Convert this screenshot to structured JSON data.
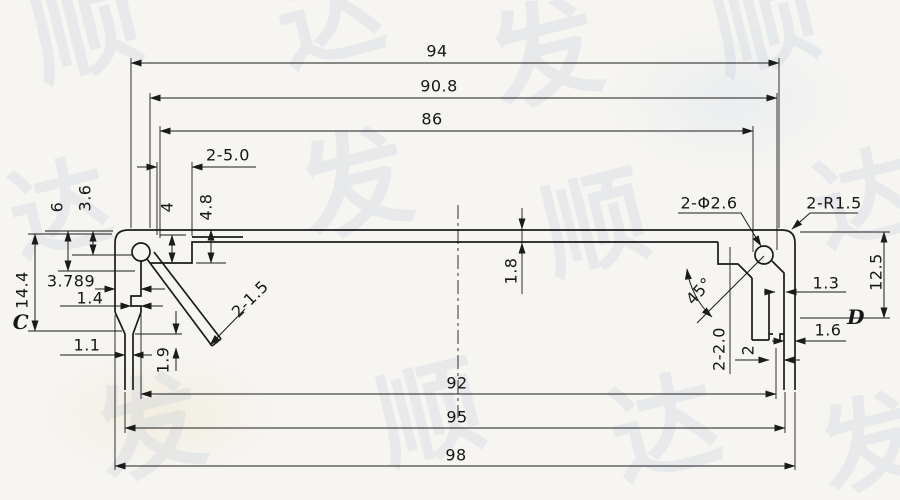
{
  "colors": {
    "ink": "#1b1b1b",
    "paper": "#f6f5f2",
    "watermark": "#a8b8cf"
  },
  "section_markers": {
    "left": "C",
    "right": "D"
  },
  "labels": {
    "dim_94": "94",
    "dim_90_8": "90.8",
    "dim_86": "86",
    "dim_2_5_0": "2-5.0",
    "dim_6": "6",
    "dim_3_6": "3.6",
    "dim_4": "4",
    "dim_4_8": "4.8",
    "dim_14_4": "14.4",
    "dim_3_789": "3.789",
    "dim_1_4": "1.4",
    "dim_1_1": "1.1",
    "dim_1_9": "1.9",
    "dim_2_1_5": "2-1.5",
    "dim_1_8": "1.8",
    "dim_2_phi_2_6": "2-Φ2.6",
    "dim_2_r1_5": "2-R1.5",
    "dim_45deg": "45°",
    "dim_1_3": "1.3",
    "dim_12_5": "12.5",
    "dim_2_2_0": "2-2.0",
    "dim_2": "2",
    "dim_1_6": "1.6",
    "dim_92": "92",
    "dim_95": "95",
    "dim_98": "98"
  },
  "watermark": {
    "glyphs": [
      "顺",
      "达",
      "发",
      "顺",
      "达",
      "发",
      "顺",
      "达",
      "发",
      "顺",
      "达",
      "发"
    ]
  }
}
